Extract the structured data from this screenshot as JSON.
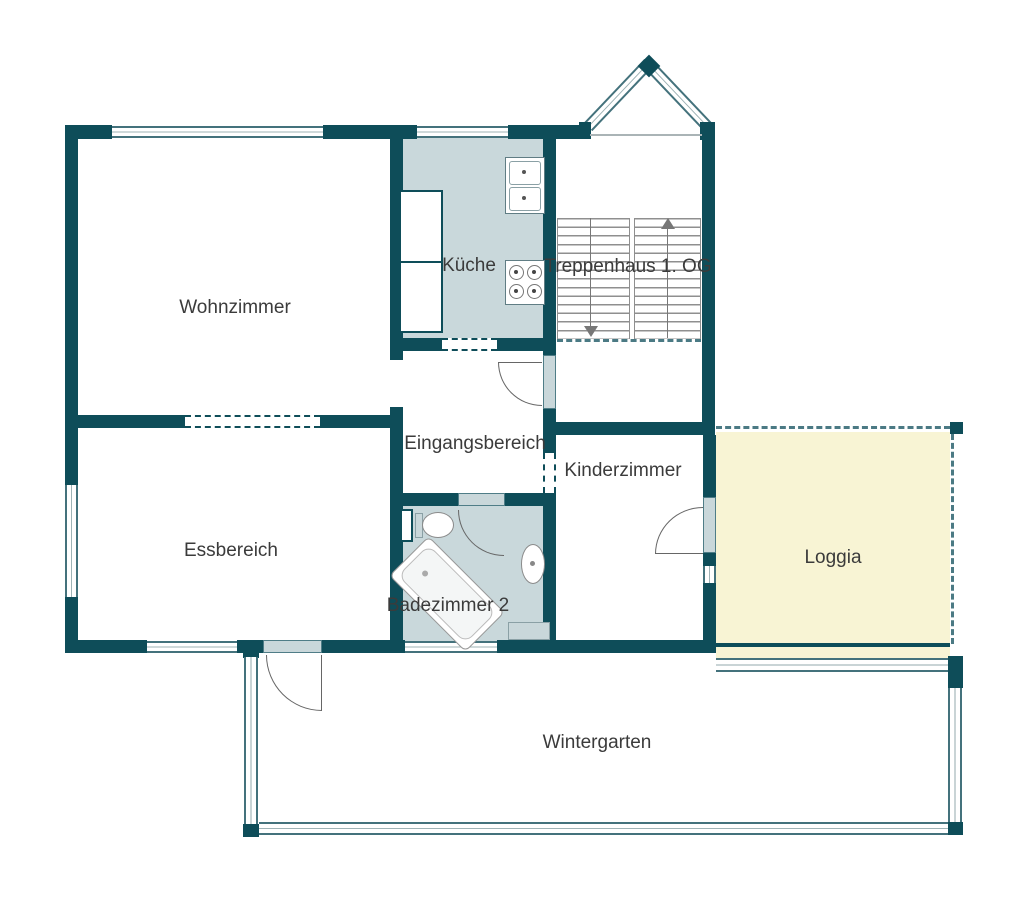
{
  "rooms": {
    "wohnzimmer": "Wohnzimmer",
    "kueche": "Küche",
    "treppenhaus": "Treppenhaus 1. OG",
    "eingangsbereich": "Eingangsbereich",
    "kinderzimmer": "Kinderzimmer",
    "essbereich": "Essbereich",
    "badezimmer": "Badezimmer 2",
    "loggia": "Loggia",
    "wintergarten": "Wintergarten"
  },
  "fixtures": [
    "toilet",
    "bathtub",
    "washbasin",
    "stove",
    "kitchen-sink",
    "kitchen-counter"
  ],
  "stairs": {
    "direction_up": "up-arrow",
    "direction_down": "down-arrow"
  },
  "colors": {
    "wall": "#0e4d59",
    "room_fill": "#c9d8db",
    "loggia_fill": "#f8f4d4",
    "label_text": "#3b3b3b",
    "stair_lines": "#8f8f8f",
    "window_frame": "#44727c"
  }
}
